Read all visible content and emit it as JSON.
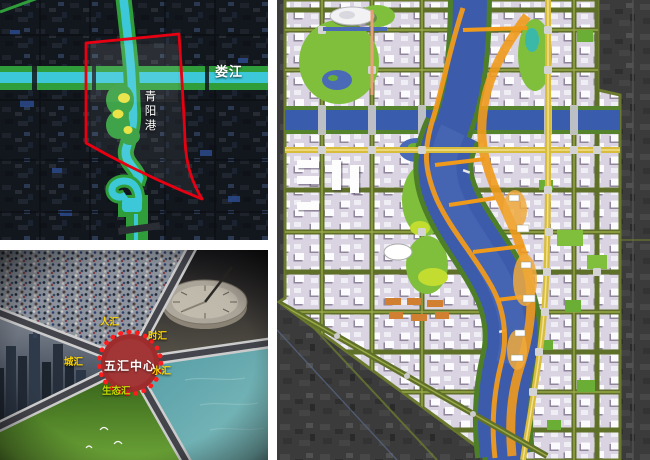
{
  "site_map": {
    "loujiang_label": "娄江",
    "qingyanggang_label": "青阳港",
    "colors": {
      "water": "#3cc8d8",
      "greenway": "#2f9e3a",
      "boundary": "#e60012",
      "wetland_yellow": "#e8e23c",
      "background": "#131720",
      "label": "#ffffff"
    }
  },
  "concept": {
    "center_label": "五汇中心",
    "spokes": [
      {
        "id": "people",
        "label": "人汇"
      },
      {
        "id": "time",
        "label": "时汇"
      },
      {
        "id": "city",
        "label": "城汇"
      },
      {
        "id": "water",
        "label": "水汇"
      },
      {
        "id": "ecology",
        "label": "生态汇"
      }
    ],
    "colors": {
      "center_fill": "#9e2c2c",
      "center_dots": "#ff1c1c",
      "label": "#ffd700",
      "eco_label": "#c6dc00",
      "spoke_road": "#46464e",
      "spoke_edge": "#d4d4d4"
    }
  },
  "master_plan": {
    "colors": {
      "river": "#3c5cab",
      "bank_green": "#4e7f28",
      "park": "#7fbf3c",
      "lime": "#c2dc30",
      "ring_orange": "#f09a1c",
      "avenue_yellow": "#d8bc3c",
      "road_olive": "#5f7028",
      "blocks": "#d9d3e2",
      "satellite": "#3c3c3c",
      "bridge": "#c8c8c8"
    }
  }
}
